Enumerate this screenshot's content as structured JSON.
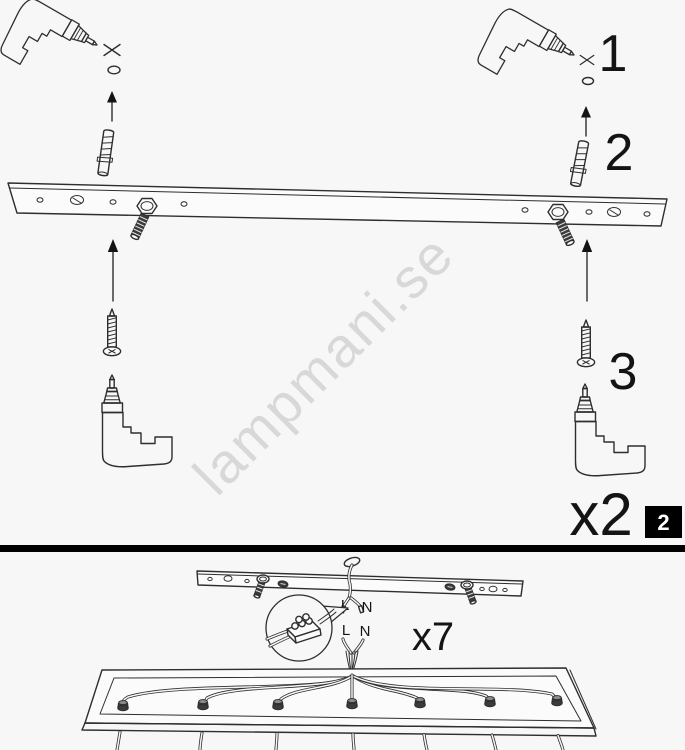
{
  "colors": {
    "background": "#f7f7f7",
    "line": "#2e2e2e",
    "dark_fill": "#3b3b3b",
    "watermark": "#d8d8d8",
    "badge_bg": "#000000",
    "badge_text": "#ffffff"
  },
  "page": {
    "watermark": "lampmani.se"
  },
  "top_section": {
    "step_labels": {
      "drill_hole": "1",
      "insert_plug": "2",
      "drive_screw": "3"
    },
    "quantity_label": "x2",
    "page_badge": "2"
  },
  "bottom_section": {
    "supply_wires": {
      "live": "L",
      "neutral": "N"
    },
    "fixture_wires": {
      "live": "L",
      "neutral": "N"
    },
    "quantity_label": "x7"
  }
}
